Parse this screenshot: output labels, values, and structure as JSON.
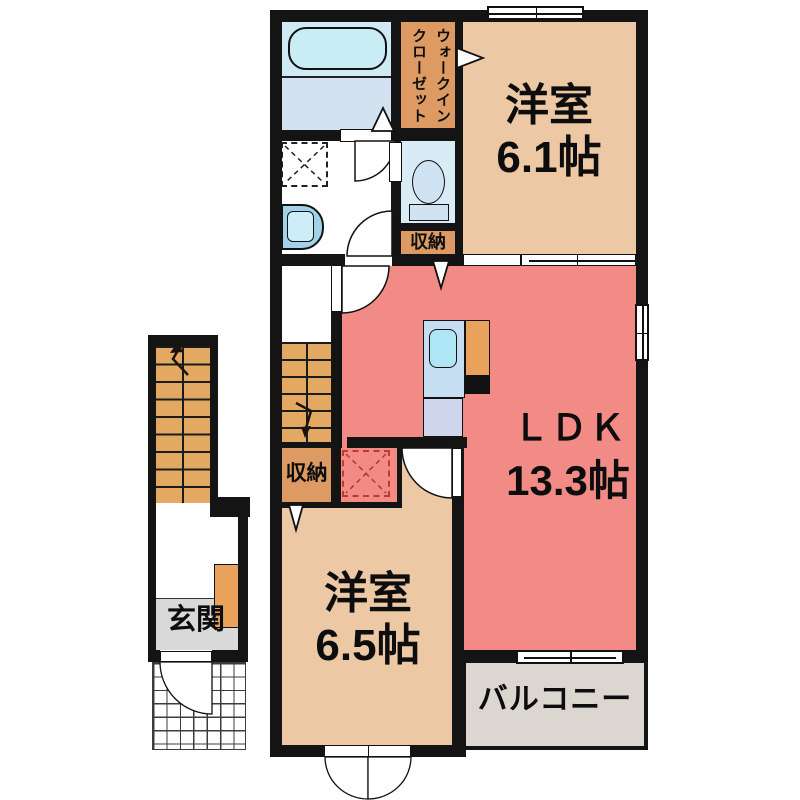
{
  "plan": {
    "bedroom1": {
      "name": "洋室",
      "size": "6.1帖"
    },
    "ldk": {
      "name": "ＬＤＫ",
      "size": "13.3帖"
    },
    "bedroom2": {
      "name": "洋室",
      "size": "6.5帖"
    },
    "balcony": {
      "name": "バルコニー"
    },
    "entrance": {
      "name": "玄関"
    },
    "wic": {
      "line1": "ウォークイン",
      "line2": "クローゼット"
    },
    "storage_upper": {
      "name": "収納"
    },
    "storage_lower": {
      "name": "収納"
    },
    "colors": {
      "wall": "#141414",
      "room_tan": "#ecc8a5",
      "ldk_salmon": "#f28b85",
      "closet_orange": "#dd9b63",
      "stairs_orange": "#e3a862",
      "bath_floor_blue": "#d2e2f1",
      "bathtub_blue": "#c9edf5",
      "toilet_blue": "#d9ecf6",
      "balcony_gray": "#dcd6d0",
      "entrance_gray": "#d9d9d9",
      "kitchen_counter_blue": "#c6def2",
      "sink_cyan": "#aee6f6",
      "dashed_red": "#c0392b"
    }
  }
}
